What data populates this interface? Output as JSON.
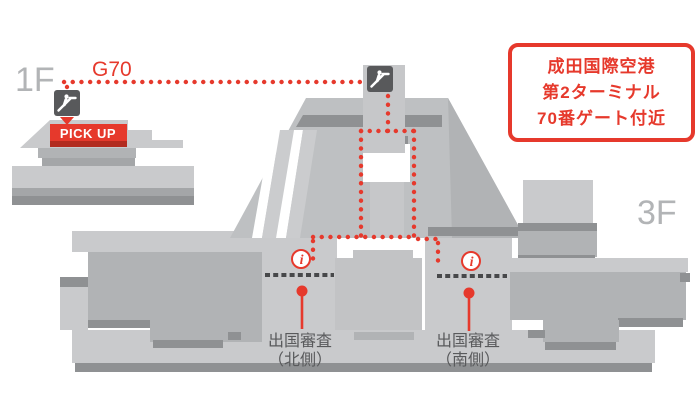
{
  "title_box": {
    "lines": [
      "成田国際空港",
      "第2ターミナル",
      "70番ゲート付近"
    ]
  },
  "labels": {
    "floor_1f": "1F",
    "floor_3f": "3F",
    "gate": "G70",
    "pickup": "PICK UP",
    "checkpoint_north_line1": "出国審査",
    "checkpoint_north_line2": "（北側）",
    "checkpoint_south_line1": "出国審査",
    "checkpoint_south_line2": "（南側）",
    "info_glyph": "i"
  },
  "icons": {
    "escalator": "escalator-icon",
    "information": "info-icon"
  },
  "colors": {
    "accent_red": "#e6392c",
    "accent_red_dark": "#b22b1f",
    "building_light": "#c9cacc",
    "building_mid": "#b1b3b5",
    "building_dark": "#8f9193",
    "icon_dark": "#58595b",
    "floor_label_gray": "#b2b4b6",
    "jp_text_gray": "#595a5c",
    "dash_dark": "#47484a"
  }
}
